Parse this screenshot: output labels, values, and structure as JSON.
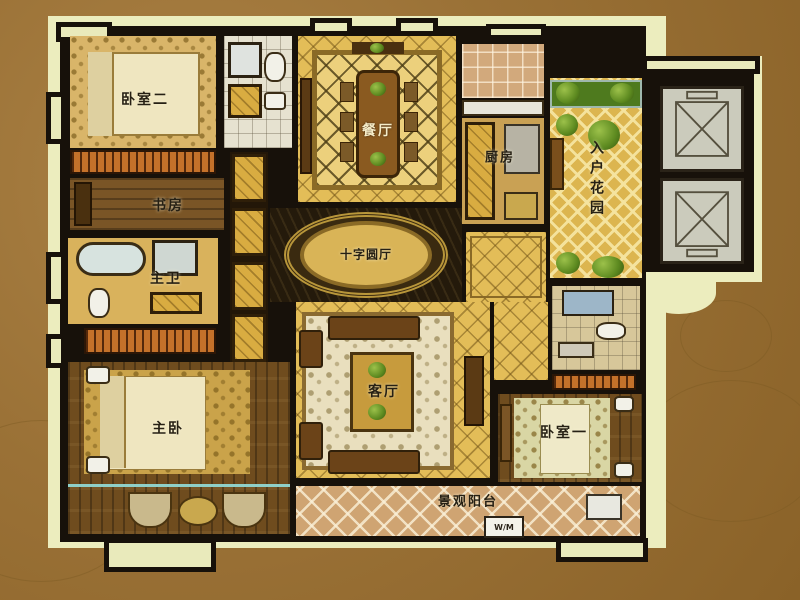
{
  "rooms": {
    "bedroom2": {
      "label": "卧室二"
    },
    "study": {
      "label": "书房"
    },
    "master_bath": {
      "label": "主卫"
    },
    "master_bedroom": {
      "label": "主卧"
    },
    "dining": {
      "label": "餐厅"
    },
    "kitchen": {
      "label": "厨房"
    },
    "entry_garden": {
      "label": "入户花园"
    },
    "cross_hall": {
      "label": "十字圆厅"
    },
    "living": {
      "label": "客厅"
    },
    "bedroom1": {
      "label": "卧室一"
    },
    "balcony": {
      "label": "景观阳台"
    }
  },
  "appliances": {
    "washer_label": "W/M"
  },
  "colors": {
    "background_brown": "#9a7136",
    "plan_cream": "#ecedbe",
    "wall_black": "#17110a",
    "floor_gold": "#e3bd58",
    "wood_brown": "#6f4c1e",
    "closet_orange": "#c4712a",
    "garden_green": "#5d8a20"
  }
}
